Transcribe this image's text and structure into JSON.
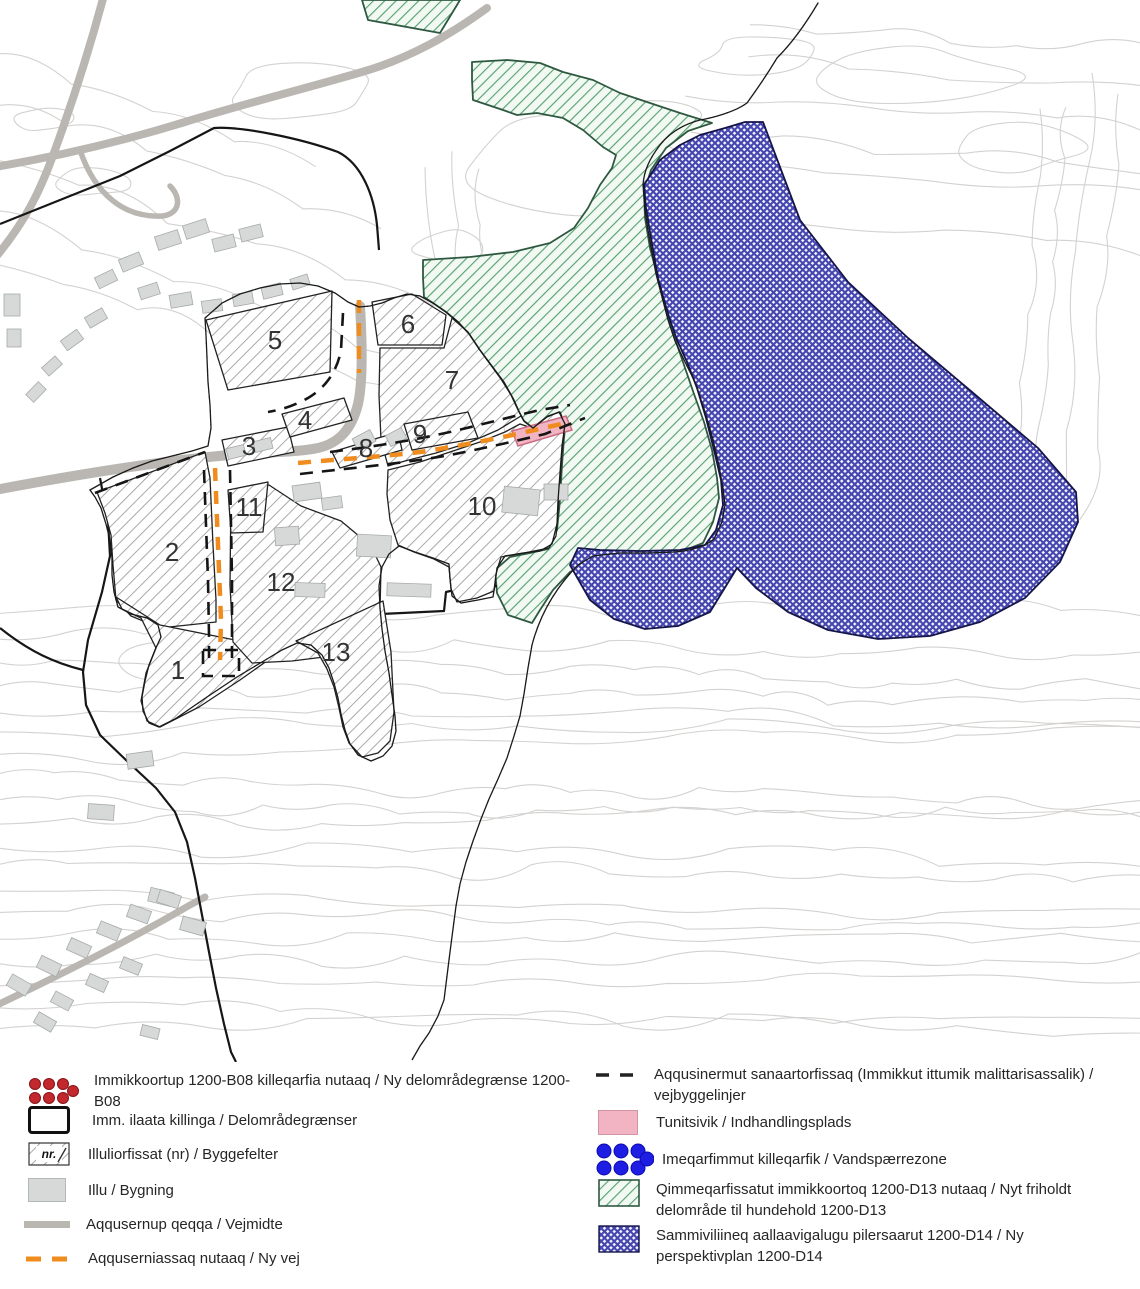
{
  "legend": {
    "left": [
      {
        "icon": "red-dots",
        "label": "Immikkoortup 1200-B08 killeqarfia nutaaq / Ny delområdegrænse 1200-B08"
      },
      {
        "icon": "black-outline-box",
        "label": "Imm. ilaata killinga / Delområdegrænser"
      },
      {
        "icon": "hatched-box-nr",
        "swatch_text": "nr.",
        "label": "Illuliorfissat (nr) / Byggefelter"
      },
      {
        "icon": "gray-box",
        "label": "Illu / Bygning"
      },
      {
        "icon": "thick-gray-line",
        "label": "Aqqusernup qeqqa / Vejmidte"
      },
      {
        "icon": "orange-dashed-line",
        "label": "Aqquserniassaq nutaaq / Ny vej"
      }
    ],
    "right": [
      {
        "icon": "black-dashed-line",
        "label": "Aqqusinermut sanaartorfissaq (Immikkut ittumik malittarisassalik) / vejbyggelinjer"
      },
      {
        "icon": "pink-box",
        "label": "Tunitsivik / Indhandlingsplads"
      },
      {
        "icon": "blue-dots",
        "label": "Imeqarfimmut killeqarfik / Vandspærrezone"
      },
      {
        "icon": "green-hatched-box",
        "label": "Qimmeqarfissatut immikkoortoq 1200-D13 nutaaq / Nyt friholdt delområde til hundehold 1200-D13"
      },
      {
        "icon": "blue-crosshatched-box",
        "label": "Sammiviliineq aallaavigalugu pilersaarut 1200-D14 / Ny perspektivplan 1200-D14"
      }
    ]
  },
  "map": {
    "areas": [
      {
        "label": "1"
      },
      {
        "label": "2"
      },
      {
        "label": "3"
      },
      {
        "label": "4"
      },
      {
        "label": "5"
      },
      {
        "label": "6"
      },
      {
        "label": "7"
      },
      {
        "label": "8"
      },
      {
        "label": "9"
      },
      {
        "label": "10"
      },
      {
        "label": "11"
      },
      {
        "label": "12"
      },
      {
        "label": "13"
      }
    ]
  },
  "colors": {
    "boundary-red": "#c2282e",
    "water-blue": "#1d1de4",
    "new-road-orange": "#ef8c1d",
    "d13-green": "#58a272",
    "d14-blue": "#4646b0",
    "pink": "#f2b3c2",
    "road-gray": "#bab7b2",
    "building-gray": "#d7d9d9",
    "hatch-gray": "#9a9a9a",
    "contour-gray": "#d4d2d0"
  }
}
